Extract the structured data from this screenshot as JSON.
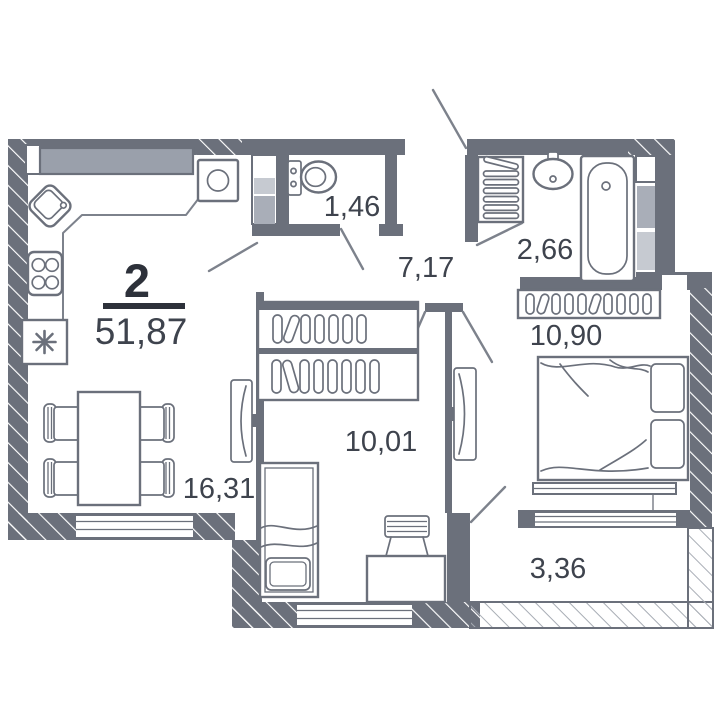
{
  "plan": {
    "room_count_label": "2",
    "total_area": "51,87",
    "rooms": [
      {
        "id": "toilet",
        "area": "1,46"
      },
      {
        "id": "hallway",
        "area": "7,17"
      },
      {
        "id": "bathroom",
        "area": "2,66"
      },
      {
        "id": "bedroom",
        "area": "10,90"
      },
      {
        "id": "room-second",
        "area": "10,01"
      },
      {
        "id": "living-kitchen",
        "area": "16,31"
      },
      {
        "id": "balcony",
        "area": "3,36"
      }
    ],
    "fixtures": [
      "kitchen-sink",
      "stove",
      "fridge",
      "washing-machine",
      "toilet",
      "wash-basin",
      "bathtub",
      "towel-radiator",
      "wardrobe-hangers",
      "double-bed",
      "single-bed",
      "desk",
      "chair",
      "dining-table",
      "tv",
      "window",
      "door-swing"
    ]
  },
  "colors": {
    "wall": "#6b707b",
    "counter": "#9aa0ab",
    "shaft_light": "#c6cad1",
    "shaft_mid": "#a9aeb8",
    "line": "#7d828c",
    "text": "#3e434d",
    "title": "#2d313a",
    "bg": "#ffffff"
  }
}
